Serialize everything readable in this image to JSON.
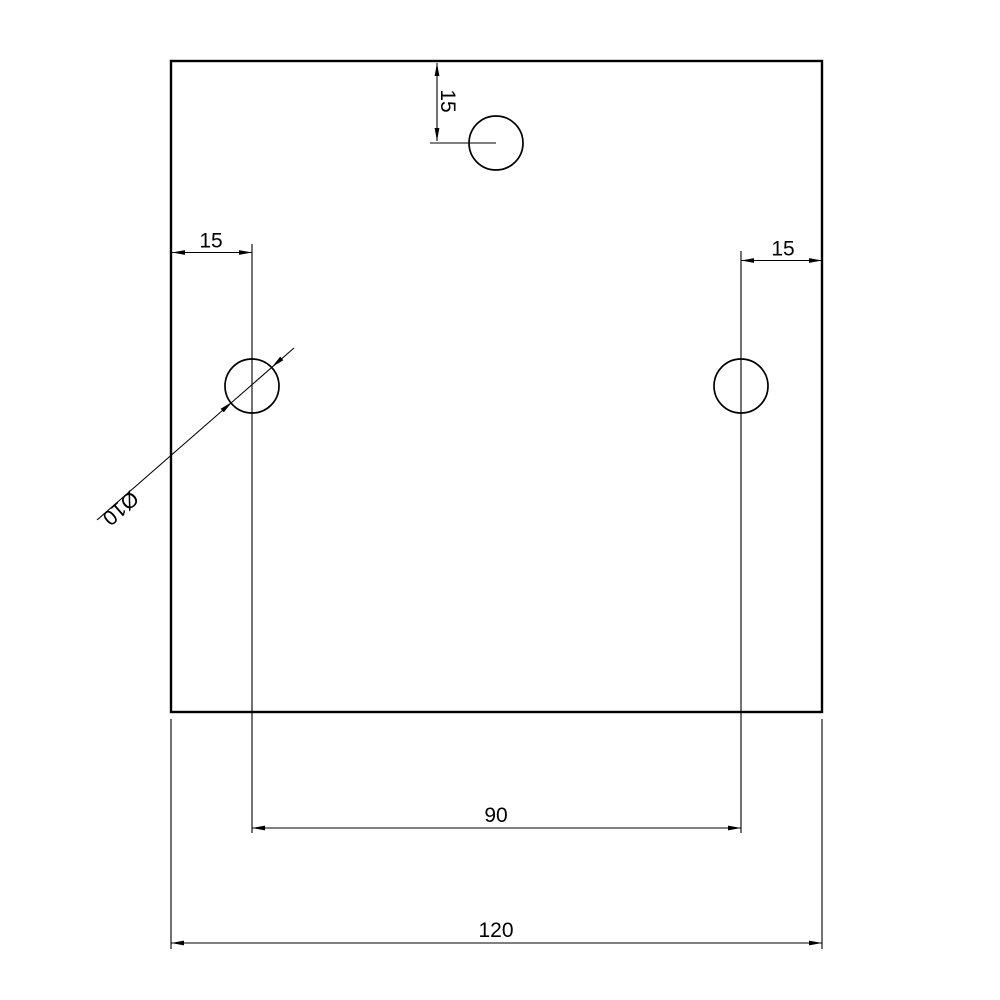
{
  "colors": {
    "background": "#ffffff",
    "line": "#000000"
  },
  "drawing": {
    "type": "technical-dimension-drawing",
    "part": "square plate with three drilled holes",
    "dimensions": {
      "top_hole_offset": {
        "label": "15",
        "value": 15,
        "orientation": "vertical"
      },
      "left_hole_offset": {
        "label": "15",
        "value": 15,
        "orientation": "horizontal"
      },
      "right_hole_offset": {
        "label": "15",
        "value": 15,
        "orientation": "horizontal"
      },
      "hole_spacing": {
        "label": "90",
        "value": 90,
        "orientation": "horizontal"
      },
      "overall_width": {
        "label": "120",
        "value": 120,
        "orientation": "horizontal"
      },
      "hole_diameter": {
        "label": "Ø10",
        "value": 10,
        "orientation": "leader"
      }
    }
  }
}
